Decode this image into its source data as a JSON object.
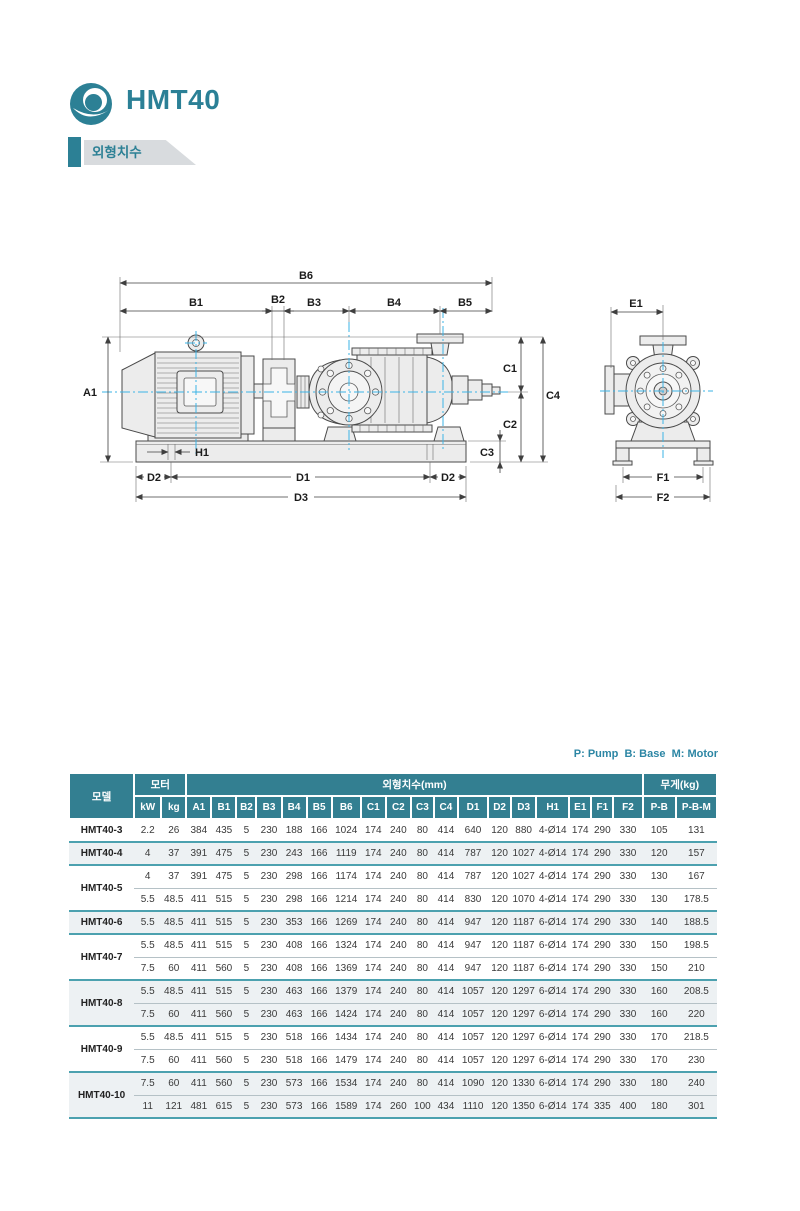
{
  "page": {
    "title": "HMT40",
    "section_label": "외형치수"
  },
  "brand_colors": {
    "teal": "#2C8095",
    "header_teal": "#337F91",
    "separator_teal": "#4CA1AF",
    "shaded_row": "#EDF1F3",
    "centerline_cyan": "#3BB3E6"
  },
  "legend": "P: Pump  B: Base  M: Motor",
  "drawing": {
    "labels": {
      "a1": "A1",
      "b1": "B1",
      "b2": "B2",
      "b3": "B3",
      "b4": "B4",
      "b5": "B5",
      "b6": "B6",
      "c1": "C1",
      "c2": "C2",
      "c3": "C3",
      "c4": "C4",
      "d1": "D1",
      "d2": "D2",
      "d3": "D3",
      "h1": "H1",
      "e1": "E1",
      "f1": "F1",
      "f2": "F2"
    }
  },
  "table": {
    "header": {
      "model": "모델",
      "motor": "모터",
      "dims": "외형치수(mm)",
      "weight": "무게(kg)",
      "sub": [
        "kW",
        "kg",
        "A1",
        "B1",
        "B2",
        "B3",
        "B4",
        "B5",
        "B6",
        "C1",
        "C2",
        "C3",
        "C4",
        "D1",
        "D2",
        "D3",
        "H1",
        "E1",
        "F1",
        "F2",
        "P-B",
        "P-B-M"
      ]
    },
    "groups": [
      {
        "model": "HMT40-3",
        "shaded": false,
        "rows": [
          [
            "2.2",
            "26",
            "384",
            "435",
            "5",
            "230",
            "188",
            "166",
            "1024",
            "174",
            "240",
            "80",
            "414",
            "640",
            "120",
            "880",
            "4-Ø14",
            "174",
            "290",
            "330",
            "105",
            "131"
          ]
        ]
      },
      {
        "model": "HMT40-4",
        "shaded": true,
        "rows": [
          [
            "4",
            "37",
            "391",
            "475",
            "5",
            "230",
            "243",
            "166",
            "1119",
            "174",
            "240",
            "80",
            "414",
            "787",
            "120",
            "1027",
            "4-Ø14",
            "174",
            "290",
            "330",
            "120",
            "157"
          ]
        ]
      },
      {
        "model": "HMT40-5",
        "shaded": false,
        "rows": [
          [
            "4",
            "37",
            "391",
            "475",
            "5",
            "230",
            "298",
            "166",
            "1174",
            "174",
            "240",
            "80",
            "414",
            "787",
            "120",
            "1027",
            "4-Ø14",
            "174",
            "290",
            "330",
            "130",
            "167"
          ],
          [
            "5.5",
            "48.5",
            "411",
            "515",
            "5",
            "230",
            "298",
            "166",
            "1214",
            "174",
            "240",
            "80",
            "414",
            "830",
            "120",
            "1070",
            "4-Ø14",
            "174",
            "290",
            "330",
            "130",
            "178.5"
          ]
        ]
      },
      {
        "model": "HMT40-6",
        "shaded": true,
        "rows": [
          [
            "5.5",
            "48.5",
            "411",
            "515",
            "5",
            "230",
            "353",
            "166",
            "1269",
            "174",
            "240",
            "80",
            "414",
            "947",
            "120",
            "1187",
            "6-Ø14",
            "174",
            "290",
            "330",
            "140",
            "188.5"
          ]
        ]
      },
      {
        "model": "HMT40-7",
        "shaded": false,
        "rows": [
          [
            "5.5",
            "48.5",
            "411",
            "515",
            "5",
            "230",
            "408",
            "166",
            "1324",
            "174",
            "240",
            "80",
            "414",
            "947",
            "120",
            "1187",
            "6-Ø14",
            "174",
            "290",
            "330",
            "150",
            "198.5"
          ],
          [
            "7.5",
            "60",
            "411",
            "560",
            "5",
            "230",
            "408",
            "166",
            "1369",
            "174",
            "240",
            "80",
            "414",
            "947",
            "120",
            "1187",
            "6-Ø14",
            "174",
            "290",
            "330",
            "150",
            "210"
          ]
        ]
      },
      {
        "model": "HMT40-8",
        "shaded": true,
        "rows": [
          [
            "5.5",
            "48.5",
            "411",
            "515",
            "5",
            "230",
            "463",
            "166",
            "1379",
            "174",
            "240",
            "80",
            "414",
            "1057",
            "120",
            "1297",
            "6-Ø14",
            "174",
            "290",
            "330",
            "160",
            "208.5"
          ],
          [
            "7.5",
            "60",
            "411",
            "560",
            "5",
            "230",
            "463",
            "166",
            "1424",
            "174",
            "240",
            "80",
            "414",
            "1057",
            "120",
            "1297",
            "6-Ø14",
            "174",
            "290",
            "330",
            "160",
            "220"
          ]
        ]
      },
      {
        "model": "HMT40-9",
        "shaded": false,
        "rows": [
          [
            "5.5",
            "48.5",
            "411",
            "515",
            "5",
            "230",
            "518",
            "166",
            "1434",
            "174",
            "240",
            "80",
            "414",
            "1057",
            "120",
            "1297",
            "6-Ø14",
            "174",
            "290",
            "330",
            "170",
            "218.5"
          ],
          [
            "7.5",
            "60",
            "411",
            "560",
            "5",
            "230",
            "518",
            "166",
            "1479",
            "174",
            "240",
            "80",
            "414",
            "1057",
            "120",
            "1297",
            "6-Ø14",
            "174",
            "290",
            "330",
            "170",
            "230"
          ]
        ]
      },
      {
        "model": "HMT40-10",
        "shaded": true,
        "rows": [
          [
            "7.5",
            "60",
            "411",
            "560",
            "5",
            "230",
            "573",
            "166",
            "1534",
            "174",
            "240",
            "80",
            "414",
            "1090",
            "120",
            "1330",
            "6-Ø14",
            "174",
            "290",
            "330",
            "180",
            "240"
          ],
          [
            "11",
            "121",
            "481",
            "615",
            "5",
            "230",
            "573",
            "166",
            "1589",
            "174",
            "260",
            "100",
            "434",
            "1110",
            "120",
            "1350",
            "6-Ø14",
            "174",
            "335",
            "400",
            "180",
            "301"
          ]
        ]
      }
    ]
  }
}
